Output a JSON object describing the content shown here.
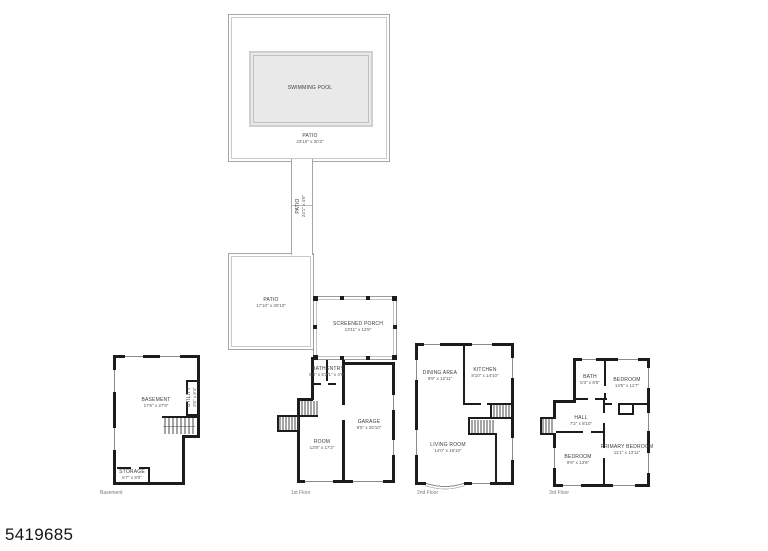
{
  "photo_id": "5419685",
  "colors": {
    "wall": "#1c1c1c",
    "patio_line": "#a6a6a6",
    "pool_fill": "#e9e9e9",
    "label_text": "#3c3c3c",
    "caption_text": "#7a7a7a"
  },
  "outdoor": {
    "pool": {
      "name": "SWIMMING POOL"
    },
    "pool_patio": {
      "name": "PATIO",
      "dims": "23'10\" x 30'3\""
    },
    "walkway": {
      "name": "PATIO",
      "dims": "24'1\" x 4'6\""
    },
    "lower_patio": {
      "name": "PATIO",
      "dims": "17'10\" x 20'10\""
    },
    "screened_porch": {
      "name": "SCREENED PORCH",
      "dims": "13'11\" x 12'8\""
    }
  },
  "floors": {
    "basement": {
      "caption": "Basement",
      "rooms": {
        "main": {
          "name": "BASEMENT",
          "dims": "17'6\" x 27'9\""
        },
        "utility": {
          "name": "UTILITY",
          "dims": "3'6\" x 8'4\""
        },
        "storage": {
          "name": "STORAGE",
          "dims": "6'7\" x 9'0\""
        }
      }
    },
    "first": {
      "caption": "1st Floor",
      "rooms": {
        "bath": {
          "name": "BATH",
          "dims": "5'0\" x 5'2\""
        },
        "entry": {
          "name": "ENTRY",
          "dims": "7'1\" x 4'9\""
        },
        "room": {
          "name": "ROOM",
          "dims": "13'8\" x 17'2\""
        },
        "garage": {
          "name": "GARAGE",
          "dims": "9'5\" x 25'10\""
        }
      }
    },
    "second": {
      "caption": "2nd Floor",
      "rooms": {
        "dining": {
          "name": "DINING AREA",
          "dims": "9'9\" x 12'11\""
        },
        "kitchen": {
          "name": "KITCHEN",
          "dims": "8'10\" x 14'10\""
        },
        "living": {
          "name": "LIVING ROOM",
          "dims": "14'0\" x 16'10\""
        }
      }
    },
    "third": {
      "caption": "3rd Floor",
      "rooms": {
        "bath": {
          "name": "BATH",
          "dims": "5'3\" x 8'5\""
        },
        "bedroom_top": {
          "name": "BEDROOM",
          "dims": "14'5\" x 11'7\""
        },
        "hall": {
          "name": "HALL",
          "dims": "7'2\" x 8'10\""
        },
        "bedroom_left": {
          "name": "BEDROOM",
          "dims": "9'9\" x 13'6\""
        },
        "primary": {
          "name": "PRIMARY BEDROOM",
          "dims": "11'1\" x 13'11\""
        }
      }
    }
  }
}
